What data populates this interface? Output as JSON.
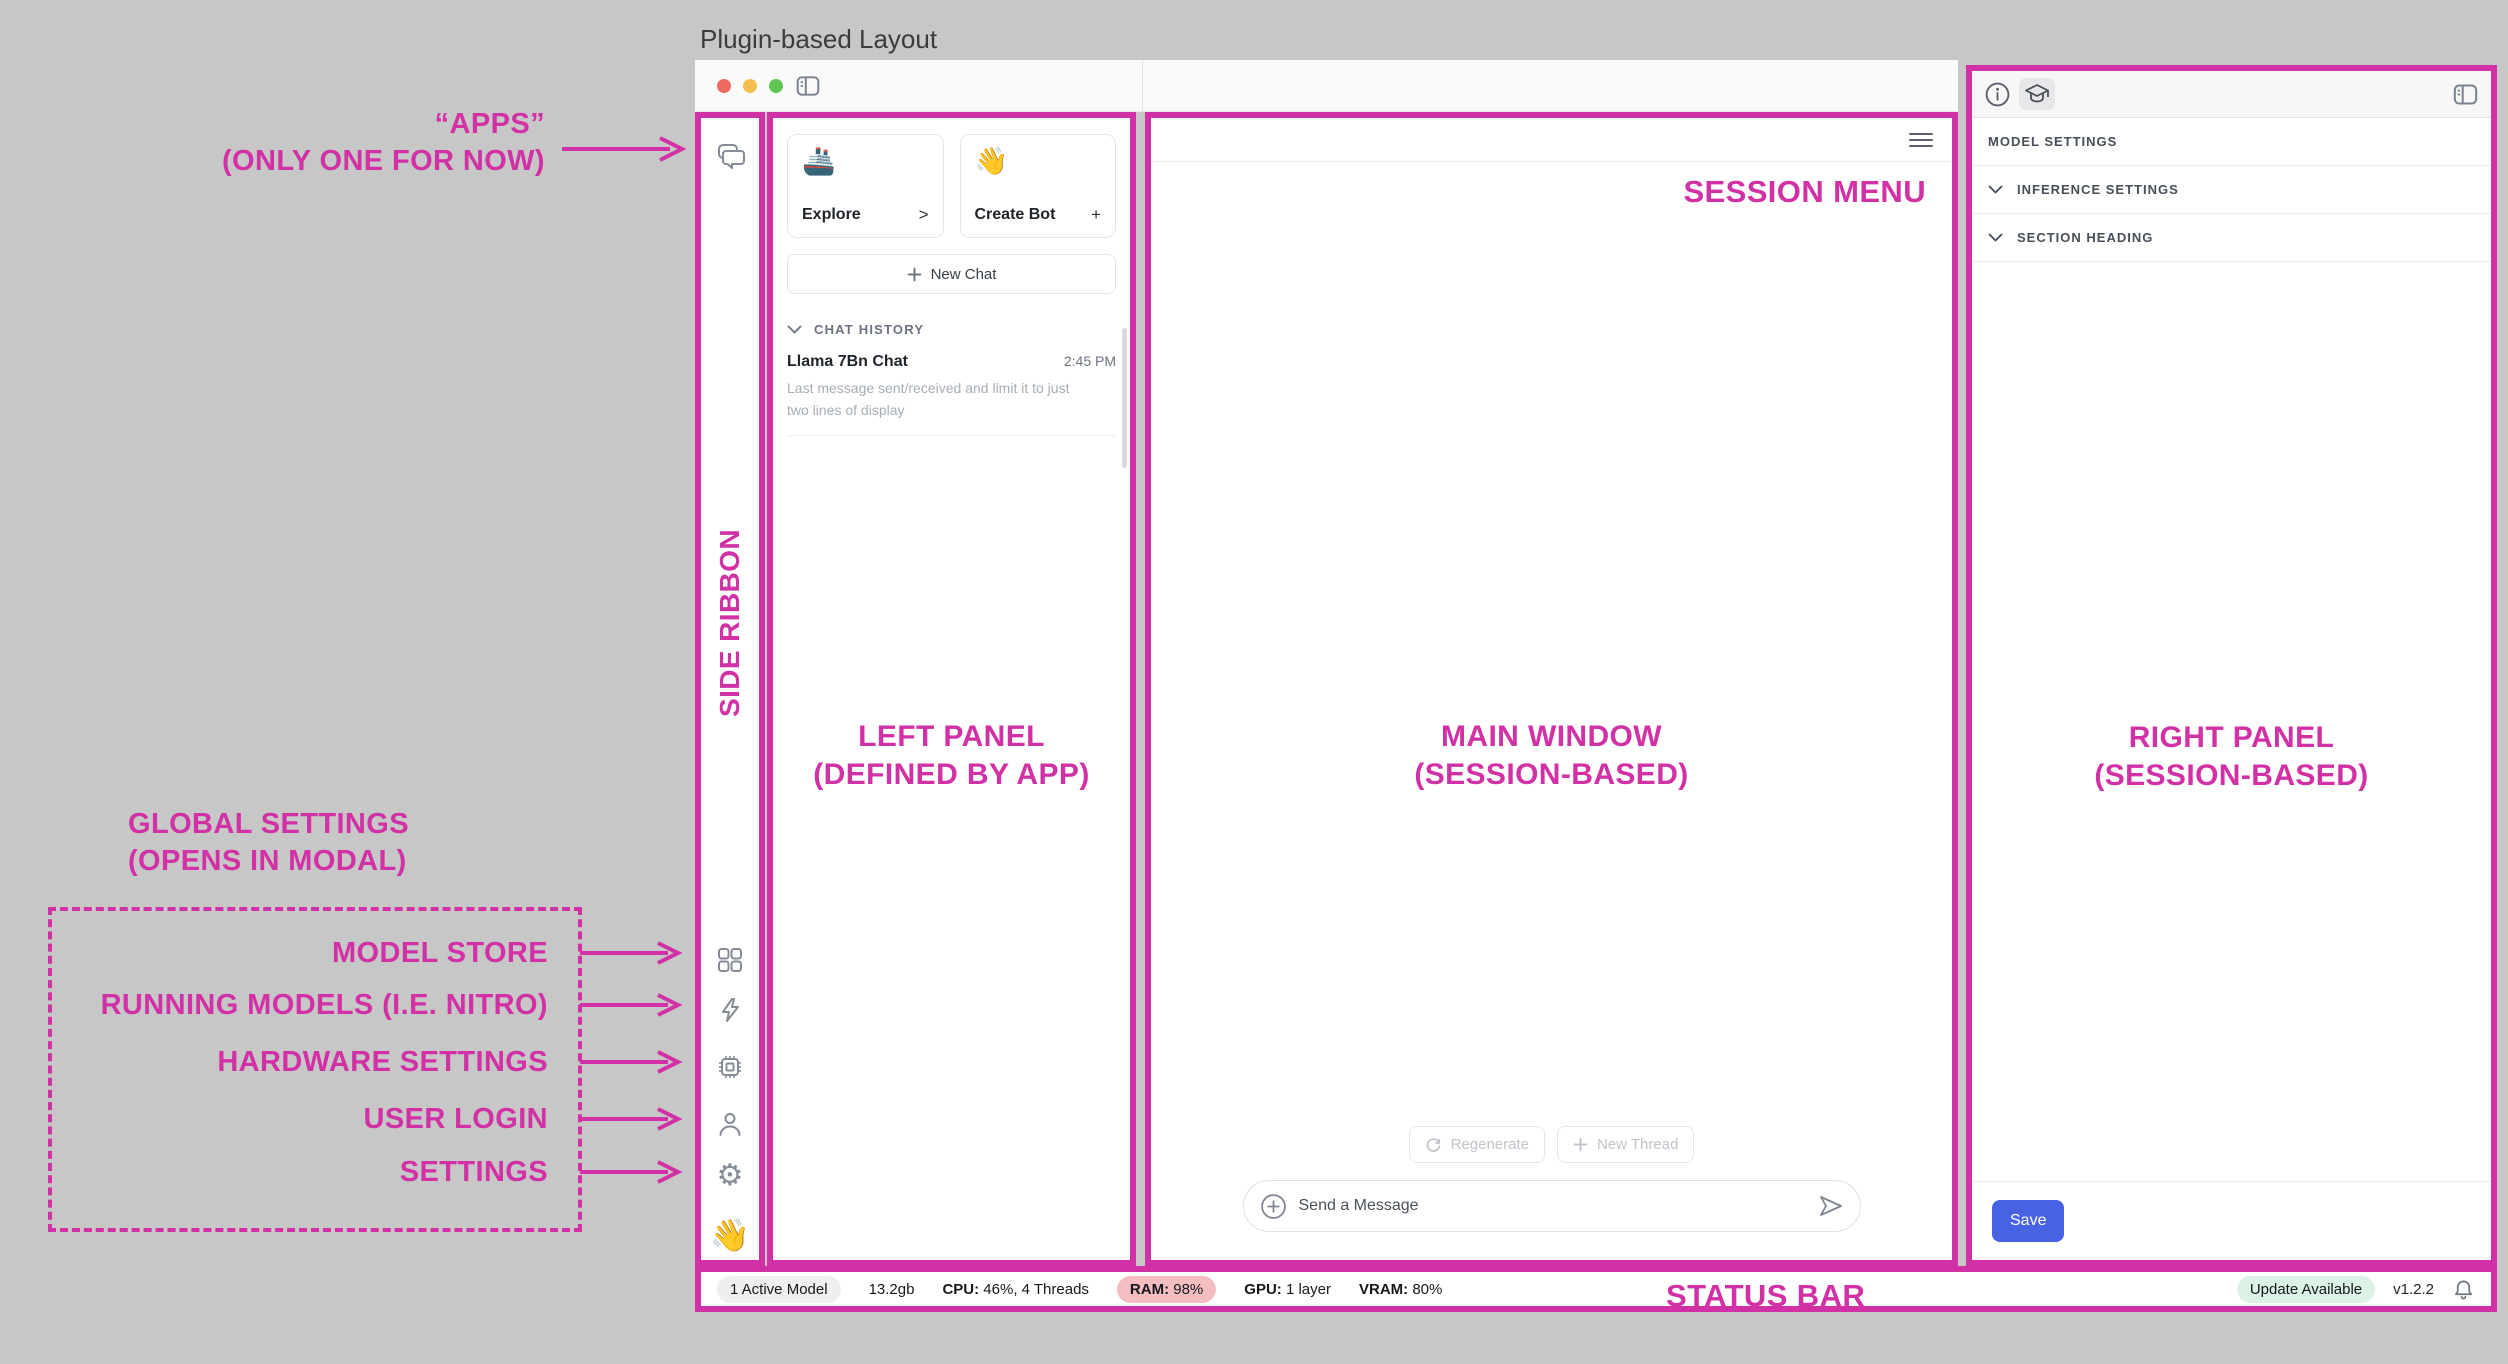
{
  "page": {
    "title": "Plugin-based Layout"
  },
  "annotations": {
    "apps": {
      "line1": "“APPS”",
      "line2": "(ONLY ONE FOR NOW)"
    },
    "side_ribbon": "SIDE RIBBON",
    "left_panel": {
      "line1": "LEFT PANEL",
      "line2": "(DEFINED BY APP)"
    },
    "main_window": {
      "line1": "MAIN WINDOW",
      "line2": "(SESSION-BASED)"
    },
    "right_panel": {
      "line1": "RIGHT PANEL",
      "line2": "(SESSION-BASED)"
    },
    "session_menu": "SESSION MENU",
    "status_bar": "STATUS BAR",
    "global_settings": {
      "line1": "GLOBAL SETTINGS",
      "line2": "(OPENS IN MODAL)"
    },
    "ribbon_targets": [
      "MODEL STORE",
      "RUNNING MODELS (I.E. NITRO)",
      "HARDWARE SETTINGS",
      "USER LOGIN",
      "SETTINGS"
    ]
  },
  "window": {
    "left_panel": {
      "cards": [
        {
          "emoji": "🚢",
          "label": "Explore",
          "action": ">"
        },
        {
          "emoji": "👋",
          "label": "Create Bot",
          "action": "+"
        }
      ],
      "new_chat": "New Chat",
      "history": {
        "heading": "CHAT HISTORY",
        "items": [
          {
            "title": "Llama 7Bn Chat",
            "time": "2:45 PM",
            "preview": "Last message sent/received and limit it to just two lines of display"
          }
        ]
      }
    },
    "main": {
      "regenerate": "Regenerate",
      "new_thread": "New Thread",
      "composer_placeholder": "Send a Message"
    },
    "right": {
      "header": "MODEL SETTINGS",
      "sections": [
        "INFERENCE SETTINGS",
        "SECTION HEADING"
      ],
      "save": "Save"
    },
    "ribbon": {
      "wave_emoji": "👋"
    },
    "status": {
      "active_models": "1 Active Model",
      "memory": "13.2gb",
      "cpu_label": "CPU:",
      "cpu_value": " 46%, 4 Threads",
      "ram_label": "RAM:",
      "ram_value": " 98%",
      "gpu_label": "GPU:",
      "gpu_value": " 1 layer",
      "vram_label": "VRAM:",
      "vram_value": " 80%",
      "update": "Update Available",
      "version": "v1.2.2"
    }
  },
  "colors": {
    "accent": "#d230a5",
    "save_blue": "#4763e4",
    "ram_pill": "#f4bdc0",
    "update_pill": "#dcf2e6"
  }
}
